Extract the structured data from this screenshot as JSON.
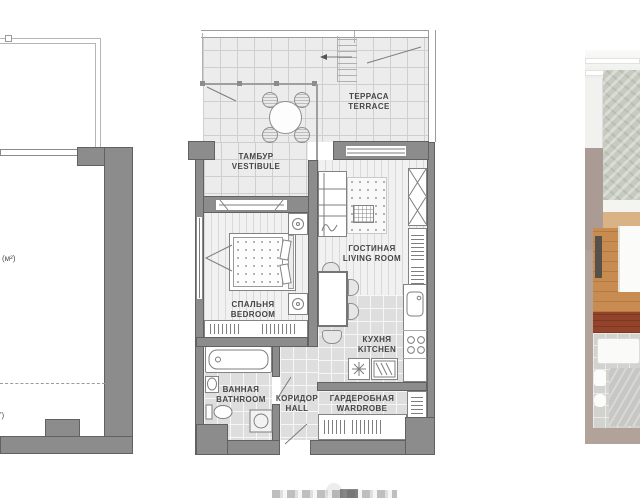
{
  "figure": {
    "type": "apartment-floor-plan-presentation"
  },
  "adjacent_plan_left": {
    "area_unit_fragment": "(м²)",
    "corner_fragment": "')"
  },
  "floor_plan": {
    "rooms": {
      "terrace": {
        "ru": "ТЕРРАСА",
        "en": "TERRACE"
      },
      "vestibule": {
        "ru": "ТАМБУР",
        "en": "VESTIBULE"
      },
      "living": {
        "ru": "ГОСТИНАЯ",
        "en": "LIVING ROOM"
      },
      "bedroom": {
        "ru": "СПАЛЬНЯ",
        "en": "BEDROOM"
      },
      "kitchen": {
        "ru": "КУХНЯ",
        "en": "KITCHEN"
      },
      "bathroom": {
        "ru": "ВАННАЯ",
        "en": "BATHROOM"
      },
      "hall": {
        "ru": "КОРИДОР",
        "en": "HALL"
      },
      "wardrobe": {
        "ru": "ГАРДЕРОБНАЯ",
        "en": "WARDROBE"
      }
    }
  },
  "colors": {
    "wall": "#8c8c8c",
    "wall_outline": "#616161",
    "tile_floor": "#ececec",
    "plank_floor": "#f1f1f1",
    "label_text": "#454545",
    "render_wood": "#c88c50",
    "render_taupe": "#ab9c95",
    "render_concrete": "#c6cabf",
    "render_red": "#94432b"
  }
}
